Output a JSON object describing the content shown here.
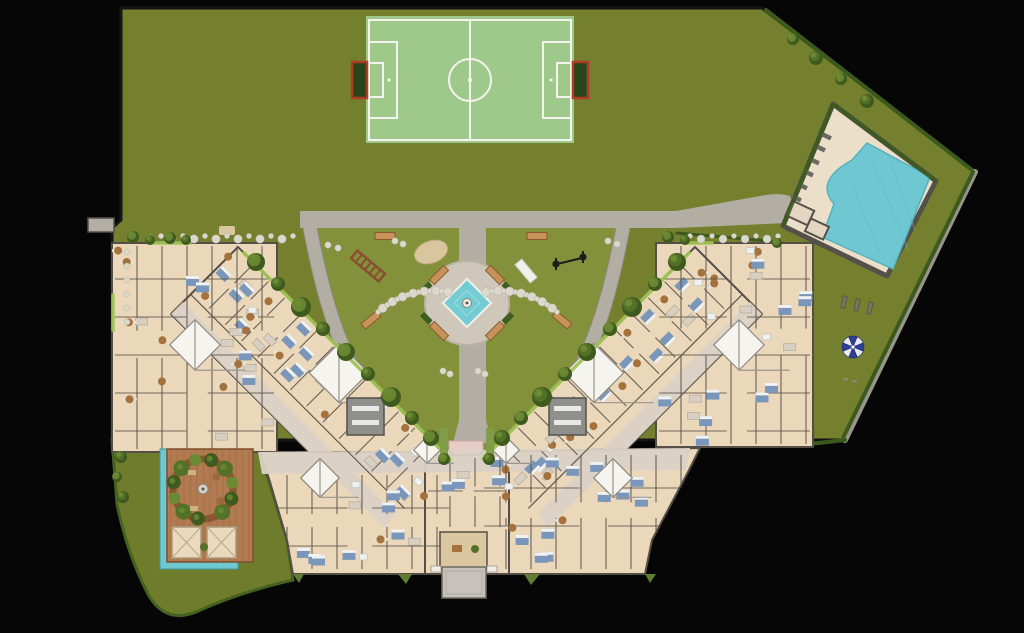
{
  "meta": {
    "title": "Residential complex site plan — top view rendering",
    "type": "architectural-site-plan"
  },
  "areas": {
    "site": "Site grounds",
    "soccer_field": "Soccer field",
    "swimming_pool": "Swimming pool area",
    "plaza": "Central plaza with fountain",
    "playground_left": "Playground (west garden)",
    "playground_right": "Playground (east garden)",
    "deck": "Wood deck terrace with planter ring",
    "lap_pool": "Lap pool",
    "lobby": "Entrance lobby",
    "canopy": "Entrance canopy",
    "building_left": "Apartment building — west wing",
    "building_right": "Apartment building — east wing",
    "building_center": "Apartment building — central block",
    "lawn_main": "Main lawn",
    "lawn_sw": "South-west lawn",
    "parasol": "Beach parasol",
    "walkways": "Walkways"
  },
  "colors": {
    "background": "#060606",
    "lawn": "#75802e",
    "lawnBright": "#83913b",
    "lawnLow": "#6e7c2b",
    "field": "#9fc98b",
    "fieldLine": "#f4f4ef",
    "goalRed": "#b23a28",
    "goalDark": "#2a451b",
    "path": "#b3aea4",
    "pathEdge": "#8e897f",
    "plaza": "#cfc8ba",
    "pinkEntry": "#e7cdc6",
    "poolWater": "#6fc8d1",
    "poolWaterDeep": "#58b8c3",
    "fountain": "#72ccd2",
    "poolDeck": "#ecdfc9",
    "deckWood": "#b17a50",
    "deckPlank": "#9d6a41",
    "building": "#ebd8ba",
    "buildingWall": "#544e47",
    "corridor": "#dbd2c6",
    "atrium": "#f6f4ef",
    "lobbyFloor": "#dcc69f",
    "hedge": "#3c5a1e",
    "hedgeLight": "#9fc355",
    "treeDark": "#3e5a1e",
    "treeMid": "#547227",
    "treeLight": "#6b8a33",
    "bench": "#c8935a",
    "benchEdge": "#8a5a2c",
    "planterBox": "#3f5c21",
    "parasolBlue": "#2e3f95",
    "canopy": "#c6c2bb",
    "pebble": "#dcd8cd",
    "sand": "#d9c69e",
    "furnBed": "#7b96bb",
    "furnWood": "#a5713c",
    "furnSofa": "#d6cfc2",
    "furnBath": "#eef1ee",
    "stairGray": "#8f8f8b"
  }
}
